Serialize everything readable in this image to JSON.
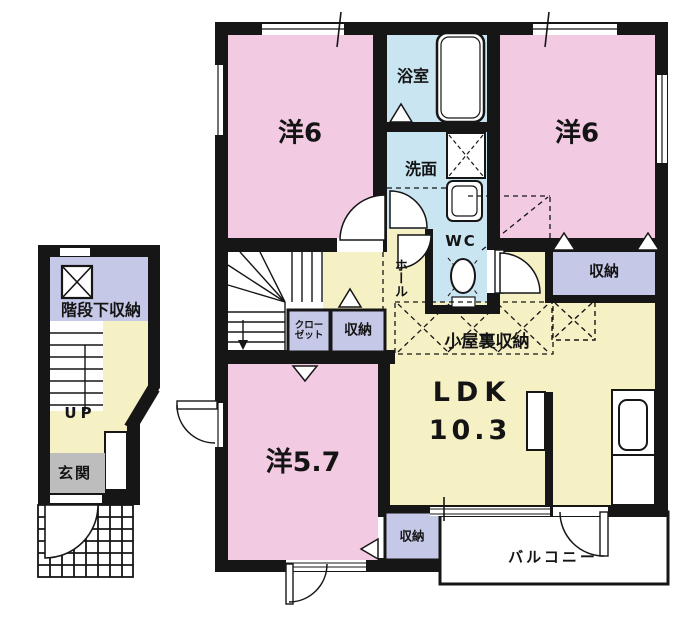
{
  "plan_type": "japanese-apartment-floor-plan",
  "palette": {
    "pink": "#F2CBE3",
    "blue": "#C9E5F1",
    "cream": "#F6F0C5",
    "lavender": "#C6C8E8",
    "gray": "#BDBDBD",
    "wall": "#161616",
    "white": "#FFFFFF"
  },
  "rooms": {
    "bedroom_top_left": {
      "label": "洋6"
    },
    "bedroom_top_right": {
      "label": "洋6"
    },
    "bathroom": {
      "label": "浴室"
    },
    "washroom": {
      "label": "洗面"
    },
    "wc": {
      "label": "WC"
    },
    "hall": {
      "label": "ホール"
    },
    "storage_right": {
      "label": "収納"
    },
    "closet": {
      "line1": "クロー",
      "line2": "ゼット"
    },
    "storage_middle": {
      "label": "収納"
    },
    "attic_storage": {
      "label": "小屋裏収納"
    },
    "ldk": {
      "label": "LDK",
      "size": "10.3"
    },
    "bedroom_bottom": {
      "label": "洋5.7"
    },
    "storage_bottom": {
      "label": "収納"
    },
    "balcony": {
      "label": "バルコニー"
    },
    "under_stair_storage": {
      "label": "階段下収納"
    },
    "stairs_up": {
      "label": "UP"
    },
    "entrance": {
      "label": "玄関"
    }
  },
  "fixtures": [
    "bathtub-icon",
    "washing-machine-icon",
    "wash-basin-icon",
    "toilet-icon",
    "kitchen-sink-icon",
    "staircase-main",
    "staircase-entry",
    "porch-tile-grid",
    "door-swing-arcs",
    "attic-access-cross"
  ]
}
